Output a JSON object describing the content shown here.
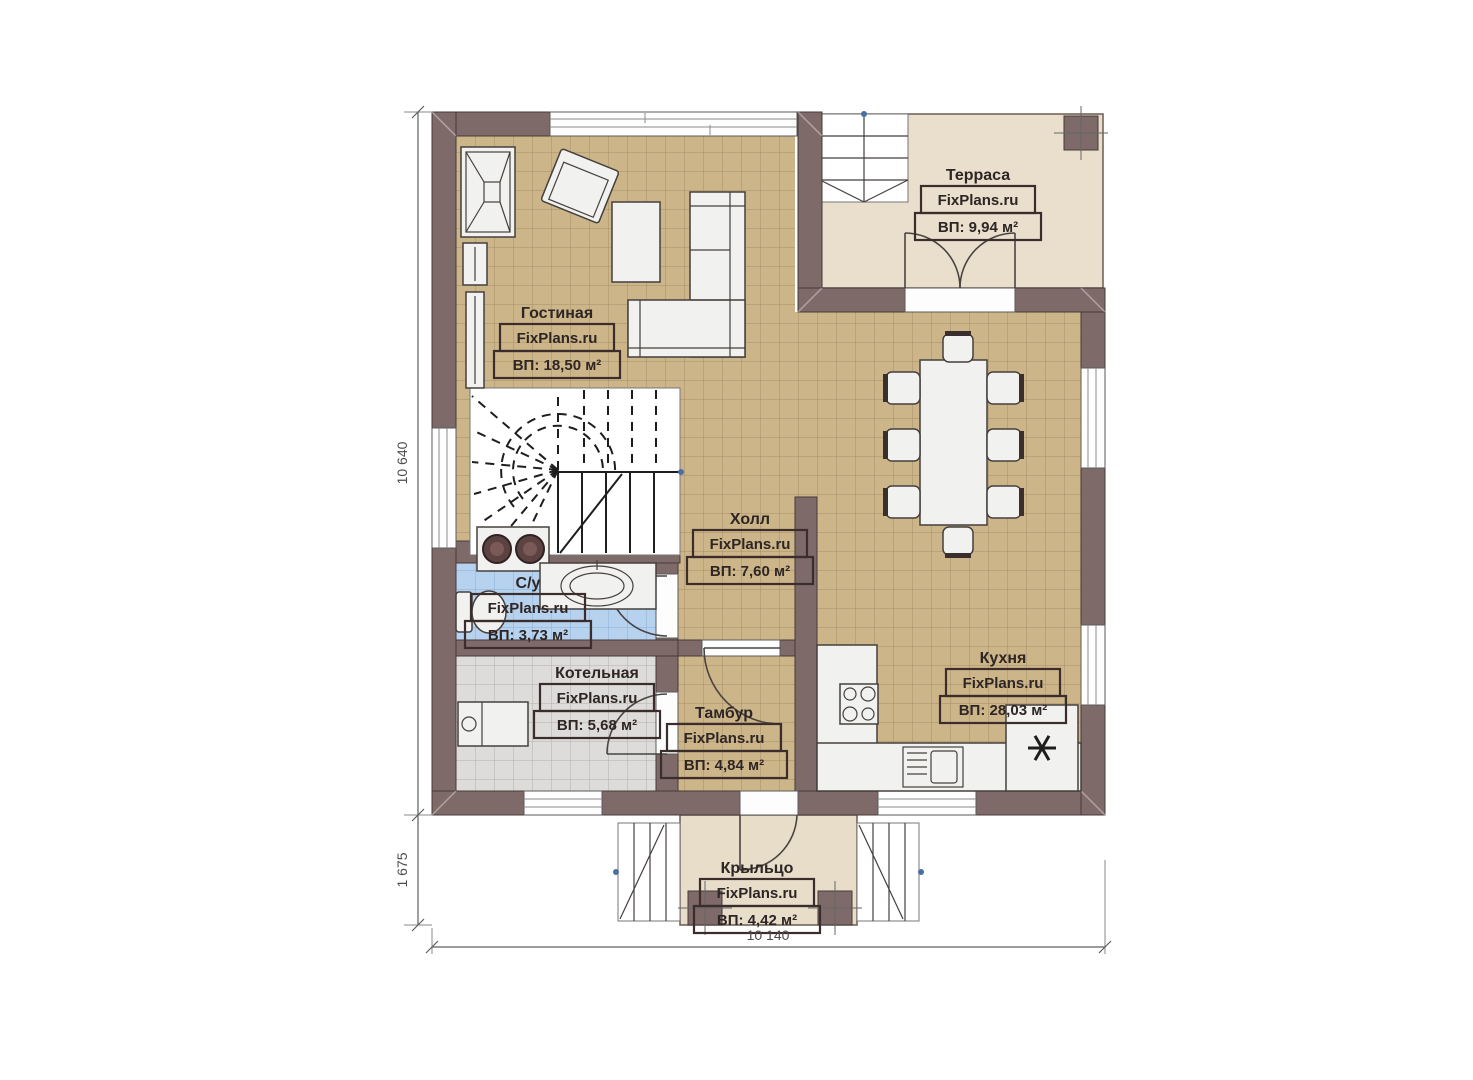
{
  "brand": {
    "label": "FixPlans.ru"
  },
  "rooms": [
    {
      "name": "Гостиная",
      "area": "ВП: 18,50 м²"
    },
    {
      "name": "Терраса",
      "area": "ВП: 9,94 м²"
    },
    {
      "name": "Холл",
      "area": "ВП: 7,60 м²"
    },
    {
      "name": "С/у",
      "area": "ВП: 3,73 м²"
    },
    {
      "name": "Котельная",
      "area": "ВП: 5,68 м²"
    },
    {
      "name": "Тамбур",
      "area": "ВП: 4,84 м²"
    },
    {
      "name": "Кухня",
      "area": "ВП: 28,03 м²"
    },
    {
      "name": "Крыльцо",
      "area": "ВП: 4,42 м²"
    }
  ],
  "dimensions": {
    "left_height": "10 640",
    "porch_height": "1 675",
    "bottom_width": "10 140"
  },
  "colors": {
    "wall": "#7e6a68",
    "tan": "#cdb58a",
    "tangrid": "#a78f66",
    "blue": "#b7d2ee",
    "bluegrid": "#86add6",
    "gray": "#dddcda",
    "graygrid": "#b3b1ae",
    "terrace": "#e9dfcc",
    "porch": "#e7ddc9",
    "line": "#3a2d2b",
    "text": "#2e2624"
  }
}
